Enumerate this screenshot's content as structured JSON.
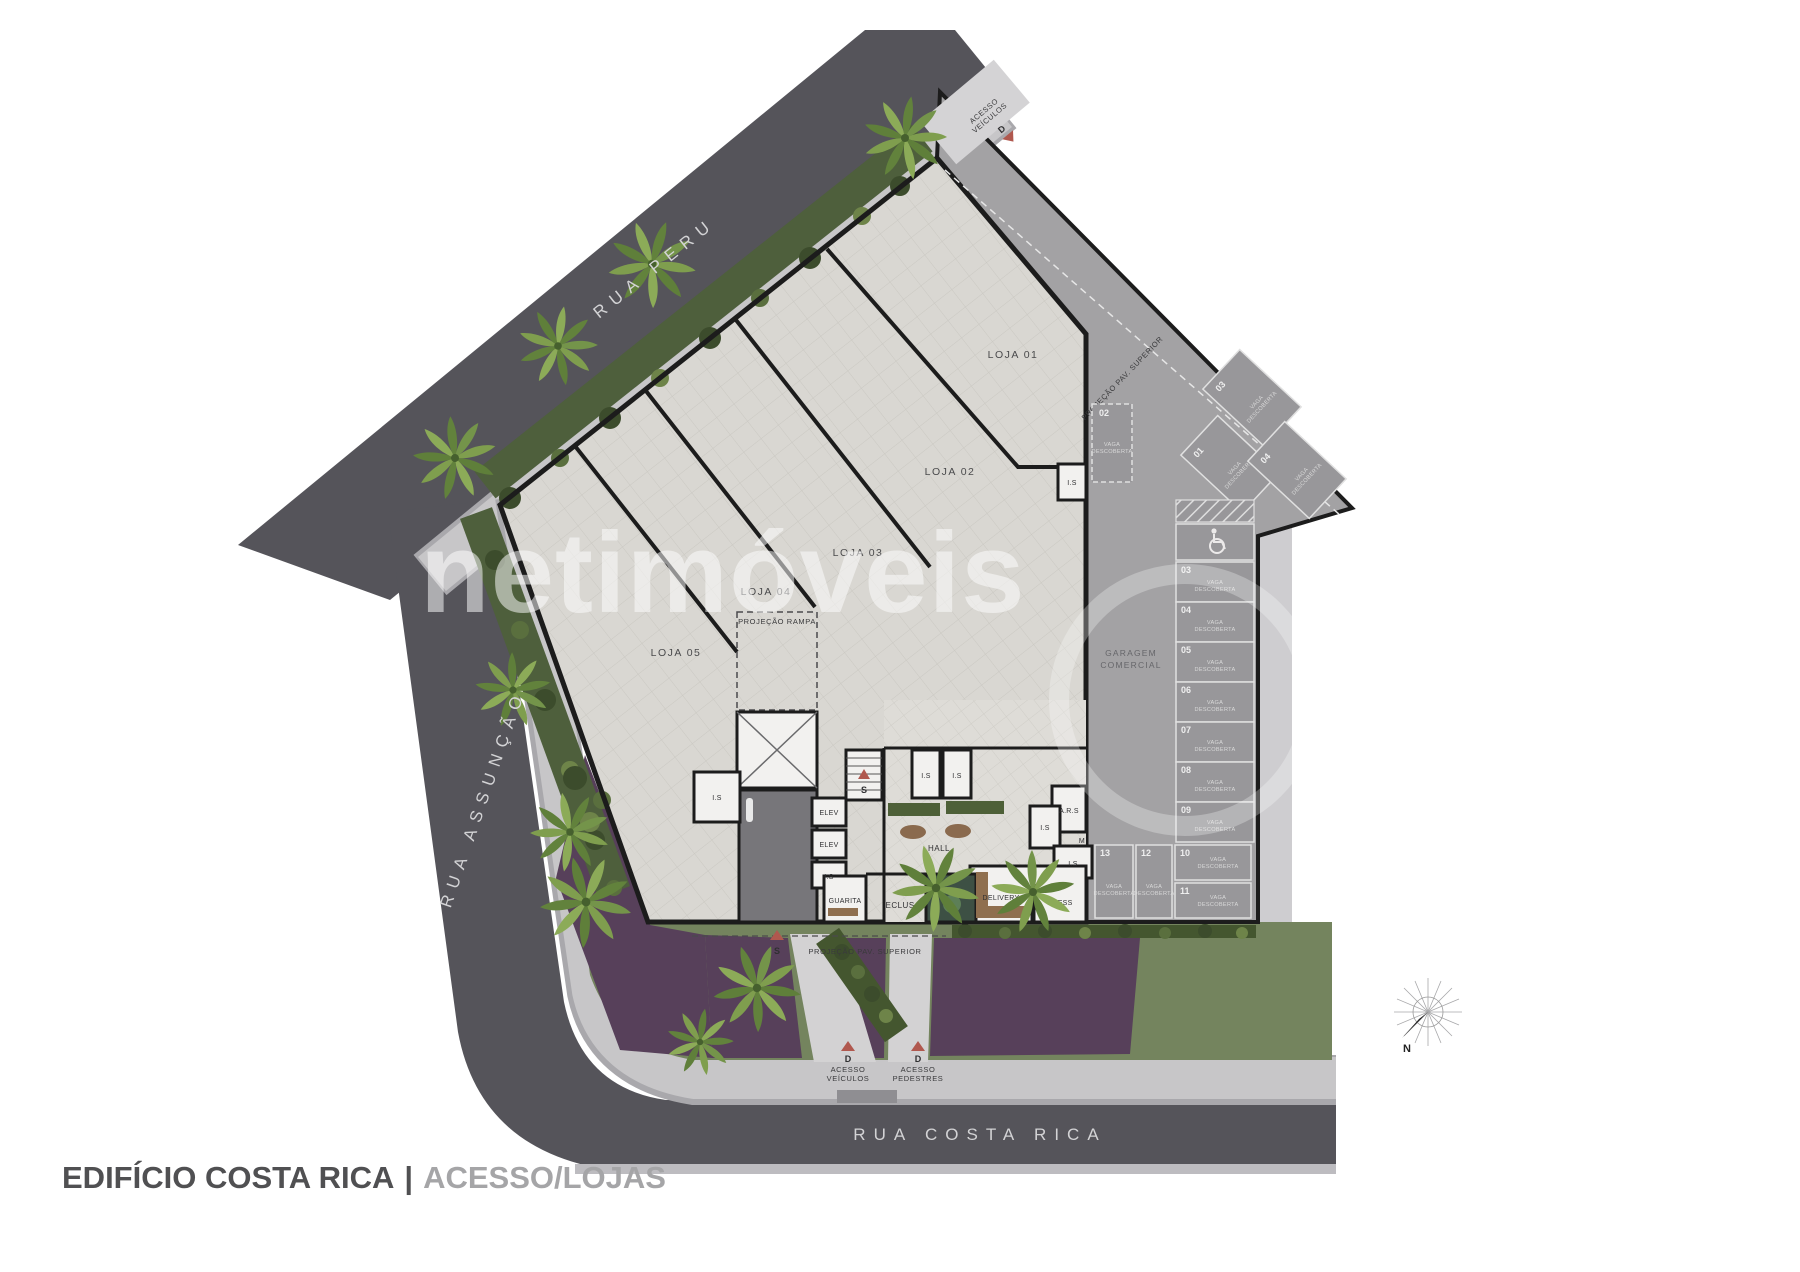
{
  "title": {
    "project": "EDIFÍCIO COSTA RICA",
    "divider": "|",
    "view": "ACESSO/LOJAS"
  },
  "watermark": "netimóveis",
  "streets": {
    "peru": "RUA PERU",
    "assuncao": "RUA ASSUNÇÃO",
    "costa_rica": "RUA COSTA RICA"
  },
  "lojas": {
    "l1": "LOJA 01",
    "l2": "LOJA 02",
    "l3": "LOJA 03",
    "l4": "LOJA 04",
    "l5": "LOJA 05"
  },
  "rooms": {
    "hall": "HALL",
    "elev": "ELEV",
    "is": "I.S",
    "guarita": "GUARITA",
    "eclusa": "ECLUSA",
    "delivery": "DELIVERY",
    "press": "PRESS",
    "ars": "A.R.S",
    "m": "M"
  },
  "annotations": {
    "projecao_rampa": "PROJEÇÃO RAMPA",
    "projecao_pav_superior": "PROJEÇÃO PAV. SUPERIOR",
    "garagem_line1": "GARAGEM",
    "garagem_line2": "COMERCIAL",
    "s": "S",
    "d": "D",
    "acesso": "ACESSO",
    "veiculos": "VEÍCULOS",
    "pedestres": "PEDESTRES"
  },
  "parking": {
    "vaga_line1": "VAGA",
    "vaga_line2": "DESCOBERTA",
    "single": "02",
    "diagonal": [
      "03",
      "01",
      "04"
    ],
    "column": [
      "03",
      "04",
      "05",
      "06",
      "07",
      "08",
      "09"
    ],
    "bottom": [
      "13",
      "12",
      "10",
      "11"
    ]
  },
  "compass": {
    "north": "N"
  },
  "colors": {
    "asphalt": "#55545a",
    "sidewalk": "#c7c6c8",
    "floor_tile": "#d9d7d2",
    "garage_concrete": "#a3a2a4",
    "stall_gray": "#98979a",
    "wall": "#1c1c1c",
    "hedge_green": "#4e5f3c",
    "palm_green": "#7f9e4e",
    "ground_purple": "#57405a",
    "lawn_green": "#74845e",
    "accent_red": "#b0584e",
    "watermark": "#ffffff",
    "title_dark": "#505052",
    "title_light": "#a5a5a7"
  }
}
